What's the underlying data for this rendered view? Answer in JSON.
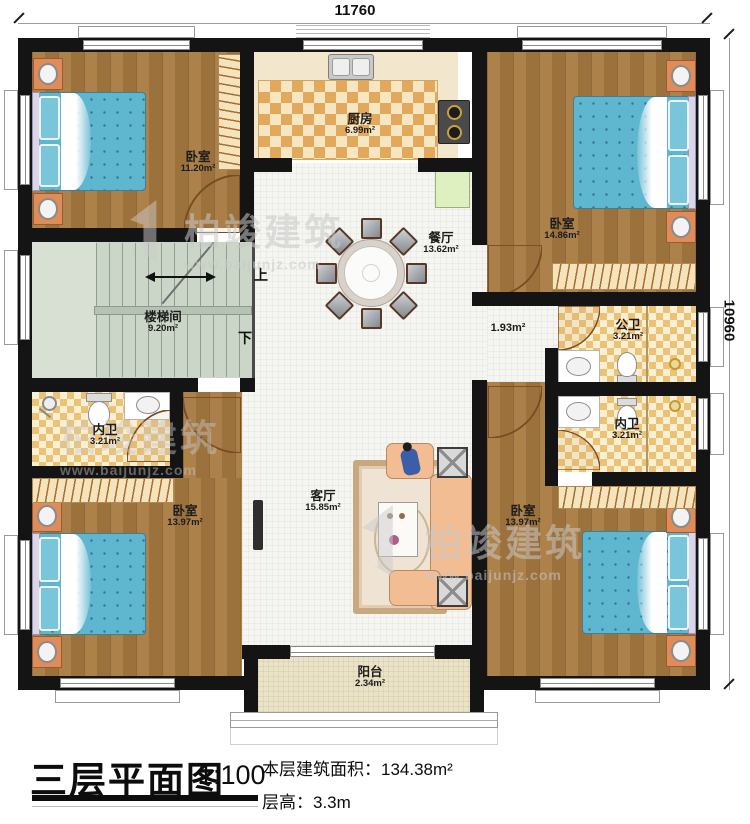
{
  "plan": {
    "dimensions": {
      "top": "11760",
      "right": "10960"
    },
    "corridor_area": "1.93m²",
    "stairs": {
      "up": "上",
      "down": "下"
    },
    "rooms": [
      {
        "id": "bedroom-top-left",
        "name": "卧室",
        "area": "11.20m²"
      },
      {
        "id": "kitchen",
        "name": "厨房",
        "area": "6.99m²"
      },
      {
        "id": "bedroom-top-right",
        "name": "卧室",
        "area": "14.86m²"
      },
      {
        "id": "dining-room",
        "name": "餐厅",
        "area": "13.62m²"
      },
      {
        "id": "stairwell",
        "name": "楼梯间",
        "area": "9.20m²"
      },
      {
        "id": "bath-inner-left",
        "name": "内卫",
        "area": "3.21m²"
      },
      {
        "id": "bath-public",
        "name": "公卫",
        "area": "3.21m²"
      },
      {
        "id": "bath-inner-right",
        "name": "内卫",
        "area": "3.21m²"
      },
      {
        "id": "bedroom-bottom-left",
        "name": "卧室",
        "area": "13.97m²"
      },
      {
        "id": "living-room",
        "name": "客厅",
        "area": "15.85m²"
      },
      {
        "id": "bedroom-bottom-right",
        "name": "卧室",
        "area": "13.97m²"
      },
      {
        "id": "balcony",
        "name": "阳台",
        "area": "2.34m²"
      }
    ]
  },
  "watermark": {
    "brand": "柏竣建筑",
    "url": "www.baijunjz.com"
  },
  "title_block": {
    "title": "三层平面图",
    "scale": "1:100",
    "floor_area_label": "本层建筑面积：",
    "floor_area_value": "134.38m²",
    "floor_height_label": "层高：",
    "floor_height_value": "3.3m"
  }
}
